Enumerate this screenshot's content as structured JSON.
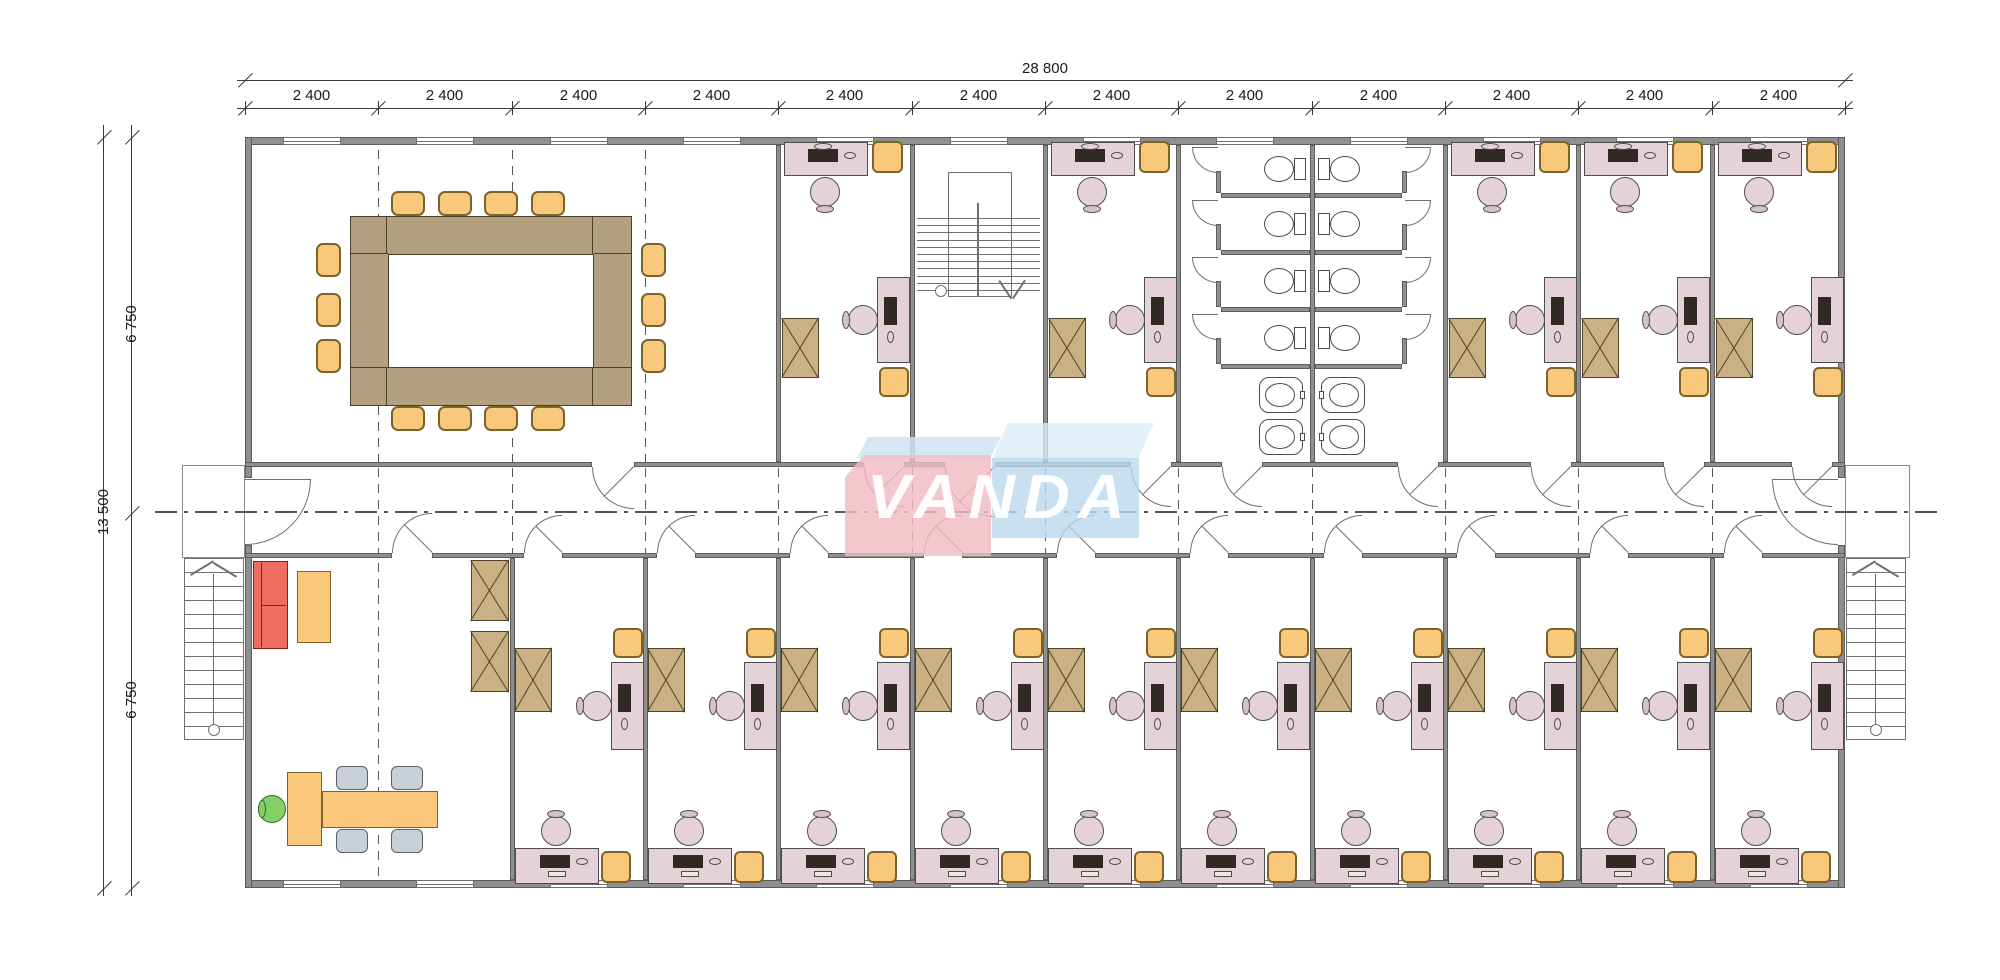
{
  "page": {
    "width": 2000,
    "height": 980,
    "background": "#ffffff"
  },
  "dimensions": {
    "total_width": "28 800",
    "bay_width": "2 400",
    "bay_count": 12,
    "total_height": "13 500",
    "half_height": "6 750"
  },
  "logo": {
    "text": "VANDA",
    "pink_front": "rgba(242,187,195,0.82)",
    "pink_top": "rgba(208,227,243,0.85)",
    "blue_front": "rgba(187,216,236,0.80)",
    "blue_top": "rgba(219,236,247,0.80)",
    "text_color": "rgba(255,255,255,0.95)"
  },
  "colors": {
    "wall": "#8f8f8f",
    "wall_edge": "#5c5c5c",
    "thin_line": "#6f6f6f",
    "dash_line": "#555555",
    "dim_line": "#3a3a3a",
    "desk": "#e5d2d9",
    "desk_edge": "#4d4d4d",
    "chair_head": "#d8c2ca",
    "monitor": "#312a22",
    "keyboard": "#efe7e0",
    "chair_orange": "#f8c87d",
    "chair_orange_edge": "#7d6327",
    "cabinet": "#c9b183",
    "cabinet_edge": "#4f4228",
    "conference_table": "#b2a080",
    "conference_table_edge": "#4a3f28",
    "sofa": "#ee6d60",
    "sofa_edge": "#7e241a",
    "table_orange": "#f9c87d",
    "chair_green": "#84cf66",
    "chair_green_edge": "#2f6b26",
    "chair_gray": "#c9d0d8",
    "chair_gray_edge": "#5a6068",
    "fixture_edge": "#4a4a4a",
    "fixture_fill": "#ffffff"
  },
  "building": {
    "bay_count": 12,
    "rooms_top": [
      {
        "name": "conference-room",
        "type": "conference",
        "bay_start": 0,
        "bay_end": 4
      },
      {
        "name": "office-top-1",
        "type": "office",
        "bay_start": 4,
        "bay_end": 5
      },
      {
        "name": "stairwell",
        "type": "stairwell",
        "bay_start": 5,
        "bay_end": 6
      },
      {
        "name": "office-top-2",
        "type": "office",
        "bay_start": 6,
        "bay_end": 7
      },
      {
        "name": "washrooms",
        "type": "washrooms",
        "bay_start": 7,
        "bay_end": 9
      },
      {
        "name": "office-top-3",
        "type": "office",
        "bay_start": 9,
        "bay_end": 10
      },
      {
        "name": "office-top-4",
        "type": "office",
        "bay_start": 10,
        "bay_end": 11
      },
      {
        "name": "office-top-5",
        "type": "office",
        "bay_start": 11,
        "bay_end": 12
      }
    ],
    "rooms_bottom": [
      {
        "name": "reception-office",
        "type": "reception",
        "bay_start": 0,
        "bay_end": 2
      },
      {
        "name": "office-bottom-1",
        "type": "office",
        "bay_start": 2,
        "bay_end": 3
      },
      {
        "name": "office-bottom-2",
        "type": "office",
        "bay_start": 3,
        "bay_end": 4
      },
      {
        "name": "office-bottom-3",
        "type": "office",
        "bay_start": 4,
        "bay_end": 5
      },
      {
        "name": "office-bottom-4",
        "type": "office",
        "bay_start": 5,
        "bay_end": 6
      },
      {
        "name": "office-bottom-5",
        "type": "office",
        "bay_start": 6,
        "bay_end": 7
      },
      {
        "name": "office-bottom-6",
        "type": "office",
        "bay_start": 7,
        "bay_end": 8
      },
      {
        "name": "office-bottom-7",
        "type": "office",
        "bay_start": 8,
        "bay_end": 9
      },
      {
        "name": "office-bottom-8",
        "type": "office",
        "bay_start": 9,
        "bay_end": 10
      },
      {
        "name": "office-bottom-9",
        "type": "office",
        "bay_start": 10,
        "bay_end": 11
      },
      {
        "name": "office-bottom-10",
        "type": "office",
        "bay_start": 11,
        "bay_end": 12
      }
    ],
    "fixtures": {
      "conference_seats": 14,
      "washroom_toilets": 8,
      "washroom_sinks": 4,
      "reception_guest_chairs": 4,
      "exterior_stairs": 2,
      "interior_stairwells": 1
    }
  }
}
